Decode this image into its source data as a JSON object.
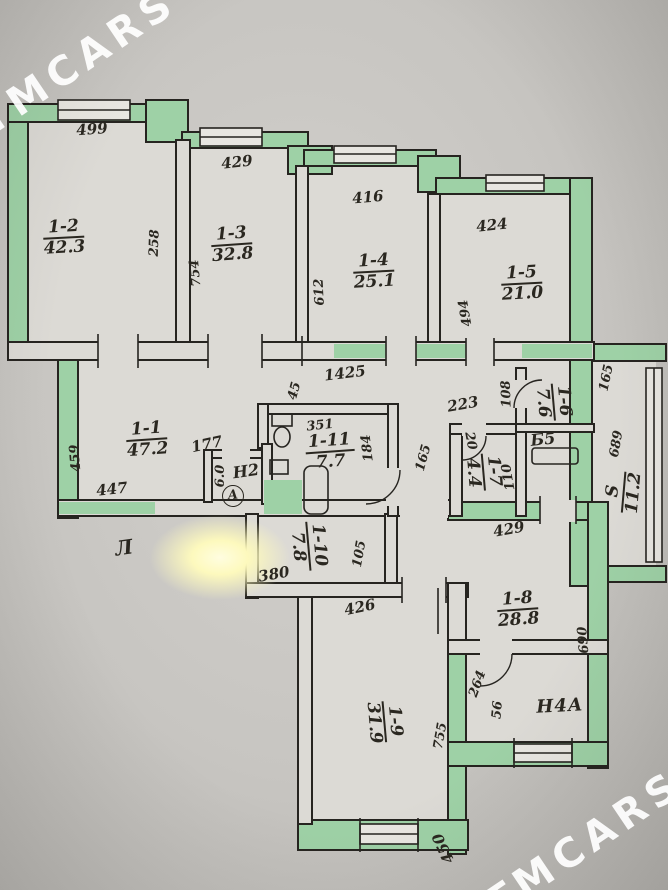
{
  "watermark": {
    "top_left": "TMCARS",
    "bottom_right": "TMCARS"
  },
  "rooms": [
    {
      "id": "1-2",
      "area": "42.3"
    },
    {
      "id": "1-3",
      "area": "32.8"
    },
    {
      "id": "1-4",
      "area": "25.1"
    },
    {
      "id": "1-5",
      "area": "21.0"
    },
    {
      "id": "1-1",
      "area": "47.2"
    },
    {
      "id": "Н2",
      "area": ""
    },
    {
      "id": "1-11",
      "area": "7.7"
    },
    {
      "id": "1-7",
      "area": "4.4"
    },
    {
      "id": "1-6",
      "area": "7.6"
    },
    {
      "id": "Б5",
      "area": ""
    },
    {
      "id": "1-10",
      "area": "7.8"
    },
    {
      "id": "1-8",
      "area": "28.8"
    },
    {
      "id": "1-9",
      "area": "31.9"
    },
    {
      "id": "Н4А",
      "area": ""
    },
    {
      "id": "S",
      "area": "11.2"
    }
  ],
  "dimensions": {
    "d499": "499",
    "d429a": "429",
    "d416": "416",
    "d424": "424",
    "d258": "258",
    "d754": "754",
    "d612": "612",
    "d494": "494",
    "d1425": "1425",
    "d45": "45",
    "d459": "459",
    "d447": "447",
    "d177": "177",
    "d60": "6.0",
    "dA": "А",
    "d351": "351",
    "d184": "184",
    "d165a": "165",
    "d223": "223",
    "d108": "108",
    "d20": "20",
    "d110": "110",
    "d165b": "165",
    "d689": "689",
    "d380": "380",
    "d105": "105",
    "d429b": "429",
    "d690": "690",
    "d426": "426",
    "d755": "755",
    "d264": "264",
    "d56": "56",
    "d450": "450",
    "mark": "Л"
  },
  "colors": {
    "wall_green": "#9ed1a6",
    "ink": "#2a2720",
    "paper": "#dcdad5"
  }
}
